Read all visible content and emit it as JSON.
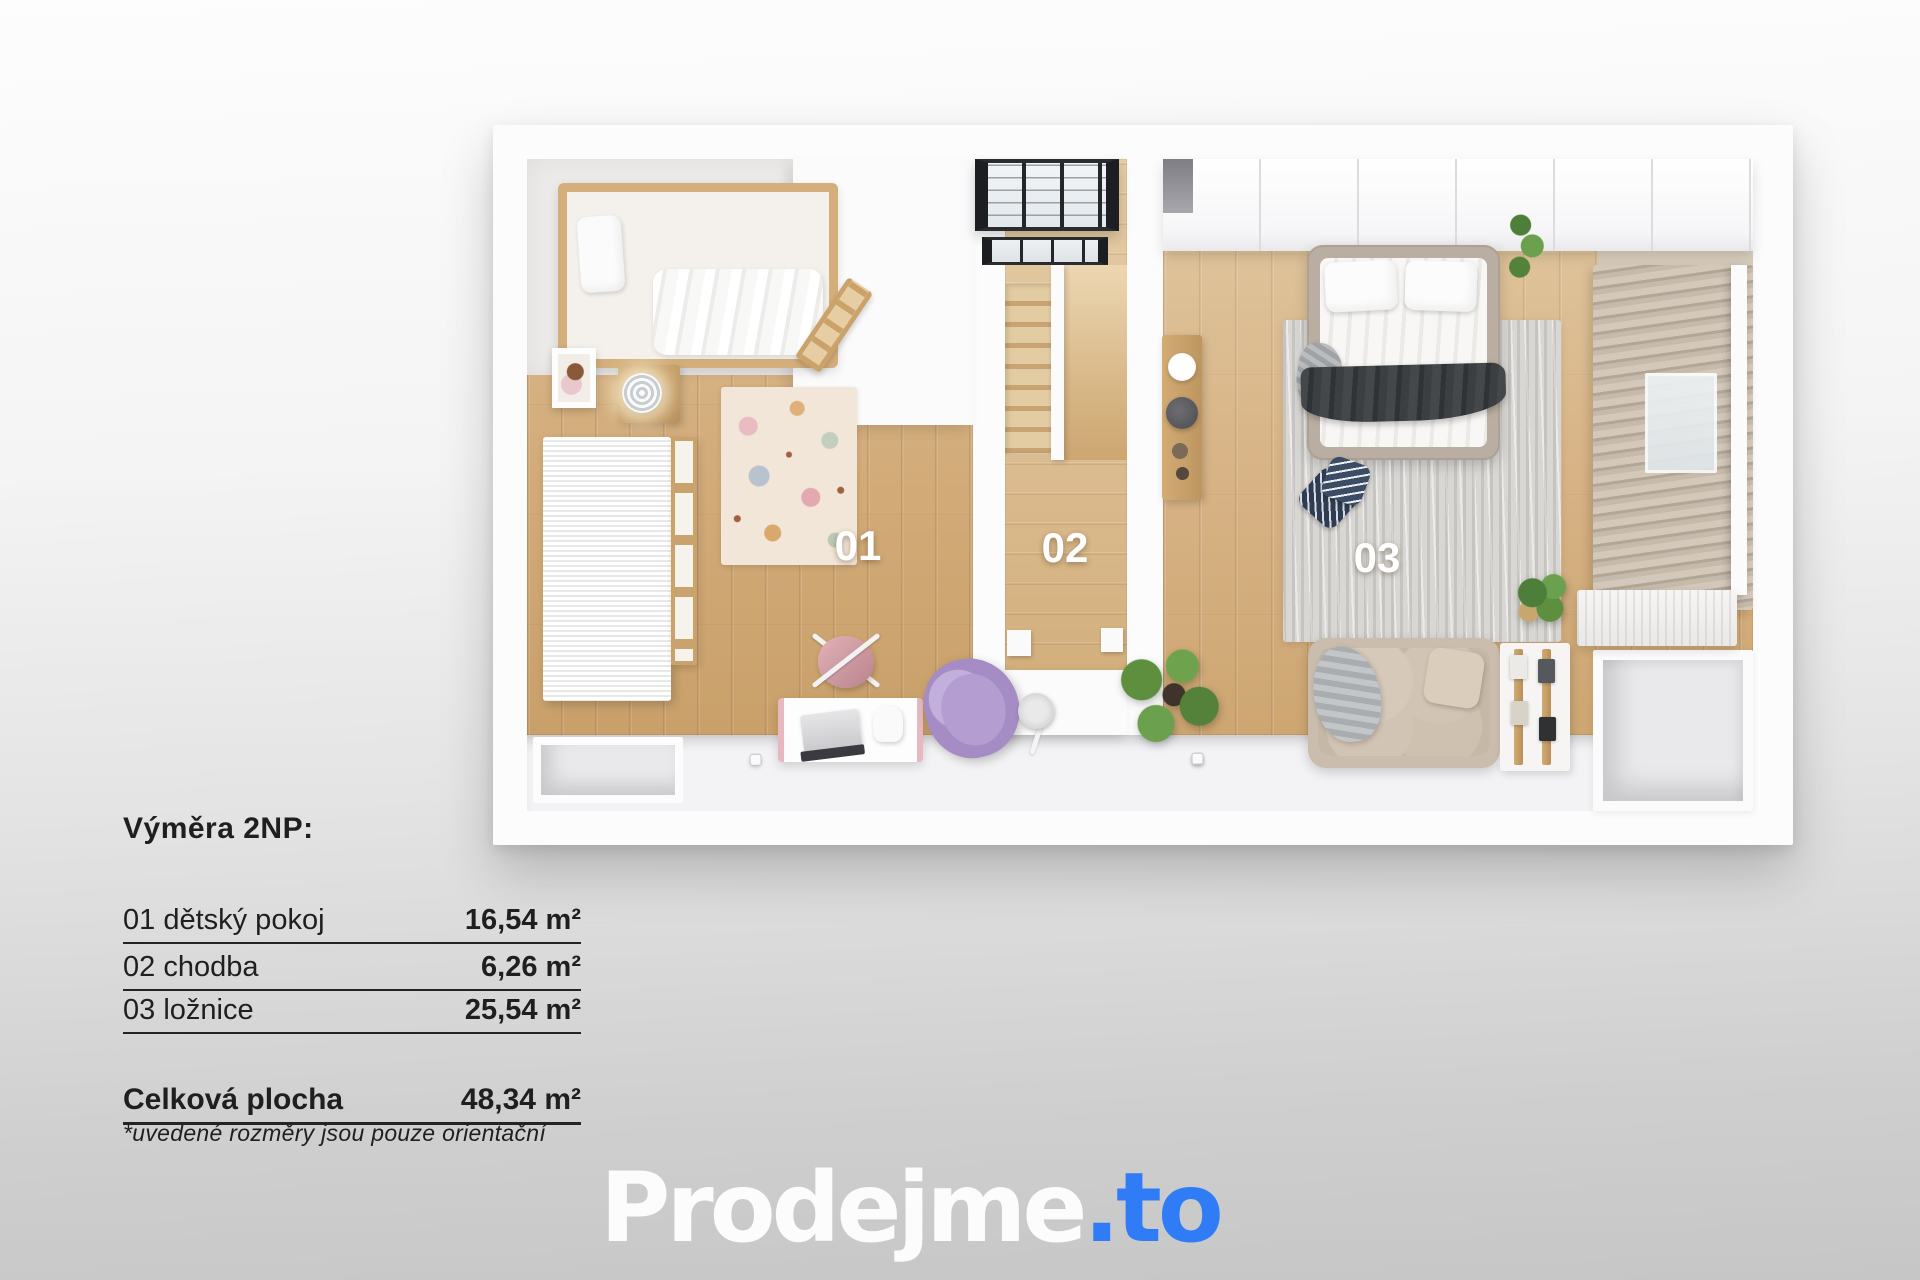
{
  "summary": {
    "heading": "Výměra 2NP:",
    "rows": [
      {
        "label": "01 dětský pokoj",
        "area": "16,54 m²"
      },
      {
        "label": "02 chodba",
        "area": "6,26 m²"
      },
      {
        "label": "03 ložnice",
        "area": "25,54 m²"
      }
    ],
    "total_label": "Celková plocha",
    "total_area": "48,34 m²",
    "footnote": "*uvedené rozměry jsou pouze orientační"
  },
  "floorplan": {
    "floor_name": "2NP",
    "rooms": [
      {
        "number": "01",
        "name": "dětský pokoj",
        "area_m2": "16,54"
      },
      {
        "number": "02",
        "name": "chodba",
        "area_m2": "6,26"
      },
      {
        "number": "03",
        "name": "ložnice",
        "area_m2": "25,54"
      }
    ],
    "total_area_m2": "48,34"
  },
  "logo": {
    "brand": "Prodejme",
    "tld": ".to",
    "accent_color": "#2f7cf6"
  },
  "colors": {
    "wood_floor": "#d2ab79",
    "wall_white": "#fbfbfc",
    "rug_cream": "#f2e6d9",
    "rug_gray": "#d8d7d4",
    "curtain_beige": "#c6baaa",
    "accent_blue": "#2f7cf6",
    "background_bottom": "#c6c6c6"
  }
}
